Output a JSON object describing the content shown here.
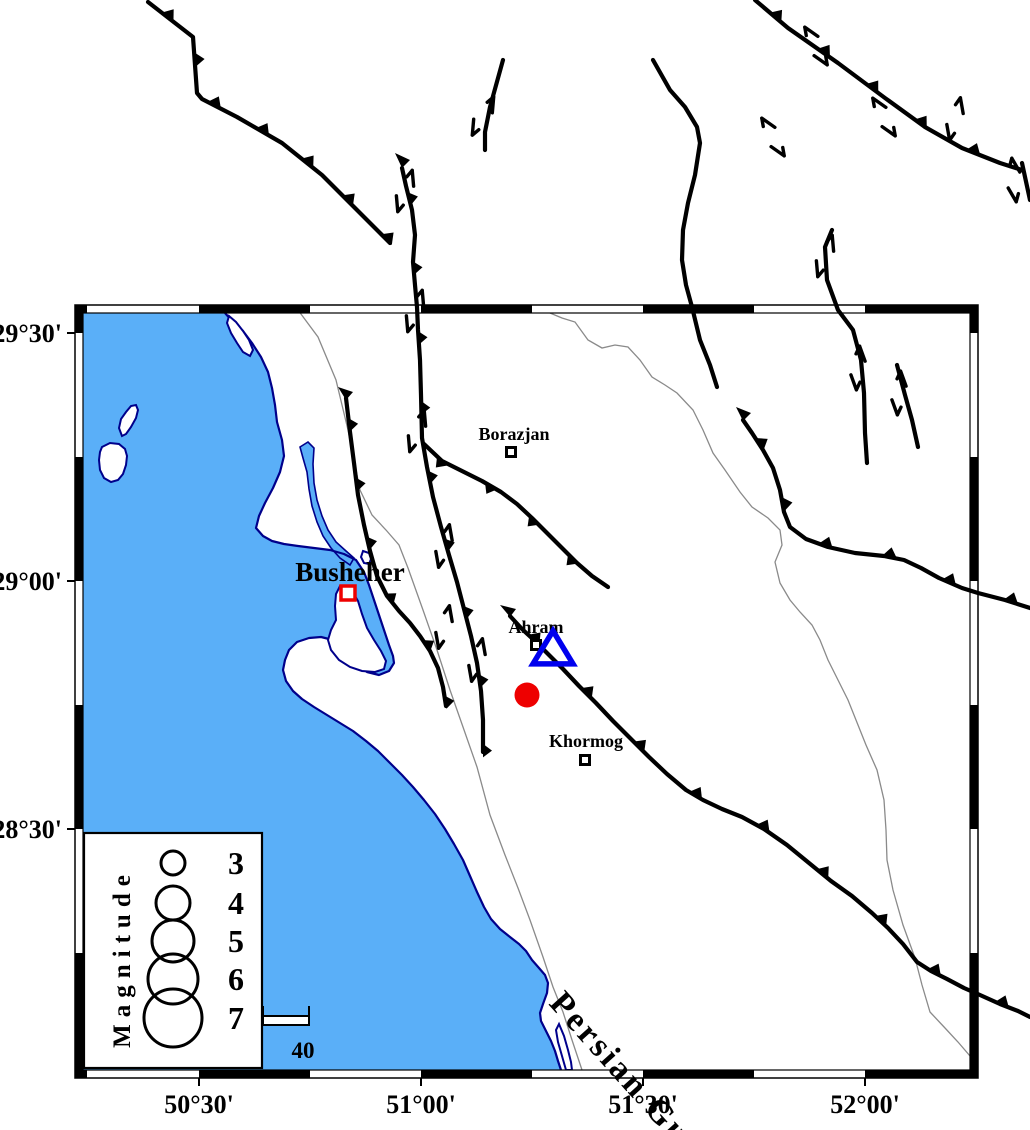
{
  "axis": {
    "lat_labels": [
      "29°30'",
      "29°00'",
      "28°30'"
    ],
    "lon_labels": [
      "50°30'",
      "51°00'",
      "51°30'",
      "52°00'"
    ]
  },
  "map": {
    "sea_label": "Persian Gulf",
    "cities": [
      {
        "name": "Borazjan",
        "major": false,
        "x": 514,
        "y": 440,
        "mx": 511,
        "my": 452
      },
      {
        "name": "Busheher",
        "major": true,
        "x": 350,
        "y": 581,
        "mx": 348,
        "my": 593
      },
      {
        "name": "Ahram",
        "major": false,
        "x": 536,
        "y": 633,
        "mx": 536,
        "my": 645
      },
      {
        "name": "Khormog",
        "major": false,
        "x": 586,
        "y": 747,
        "mx": 585,
        "my": 760
      }
    ],
    "symbols": {
      "epicenter": {
        "shape": "filled-circle",
        "x": 527,
        "y": 695,
        "r": 12.5
      },
      "station": {
        "shape": "open-triangle",
        "x": 553,
        "y": 650,
        "half_width": 20,
        "height": 33
      }
    }
  },
  "legend": {
    "title": "Magnitude",
    "magnitudes": [
      {
        "value": "3",
        "r": 12,
        "cy": 863
      },
      {
        "value": "4",
        "r": 17,
        "cy": 903
      },
      {
        "value": "5",
        "r": 21,
        "cy": 941
      },
      {
        "value": "6",
        "r": 25,
        "cy": 979
      },
      {
        "value": "7",
        "r": 29,
        "cy": 1018
      }
    ],
    "scale_bar": {
      "label": "40"
    }
  },
  "colors": {
    "sea": "#5aaff8",
    "coastline": "#00008b",
    "boundary_line": "#8a8a8a",
    "fault": "#000000",
    "epicenter": "#ee0000",
    "station": "#0000ee",
    "major_city_marker": "#ee0000",
    "land": "#ffffff",
    "frame": "#000000"
  }
}
